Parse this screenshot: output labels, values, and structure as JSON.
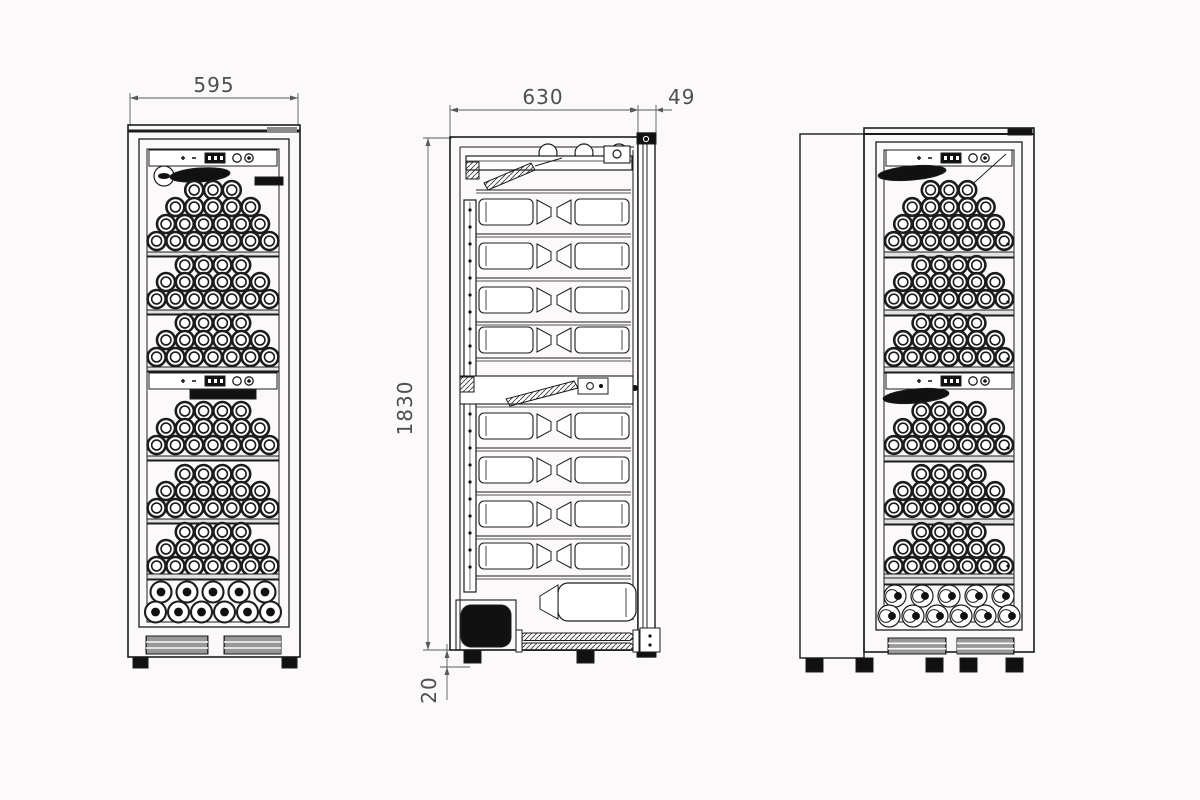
{
  "background": "#fbf9fa",
  "ink": "#1c1c1c",
  "shelf_fill": "#e2e2e2",
  "dim": {
    "color": "#4f4f4f",
    "front_width": "595",
    "side_depth": "630",
    "door_thickness": "49",
    "unit_height": "1830",
    "foot_height": "20"
  },
  "controls": {
    "plus": "+",
    "minus": "-",
    "display_segments": 3,
    "button_count": 2
  },
  "front": {
    "sections": [
      [
        3,
        5,
        6,
        7
      ],
      [
        4,
        6,
        7
      ],
      [
        4,
        6,
        7
      ],
      [
        4,
        6,
        7
      ],
      [
        4,
        6,
        7
      ],
      [
        4,
        6,
        7
      ]
    ],
    "bottom_rows": [
      5,
      6
    ],
    "vent_count": 2,
    "foot_count": 2
  },
  "side": {
    "upper_rows": 4,
    "lower_rows": 4,
    "condenser_tubes": 2,
    "rail_dots": 22,
    "foot_count": 2
  },
  "perspective": {
    "sections": [
      [
        3,
        5,
        6,
        7
      ],
      [
        4,
        6,
        7
      ],
      [
        4,
        6,
        7
      ],
      [
        4,
        6,
        7
      ],
      [
        4,
        6,
        7
      ],
      [
        4,
        6,
        7
      ]
    ],
    "bottom_rows": [
      5,
      6
    ],
    "vent_count": 2,
    "foot_count": 5
  }
}
